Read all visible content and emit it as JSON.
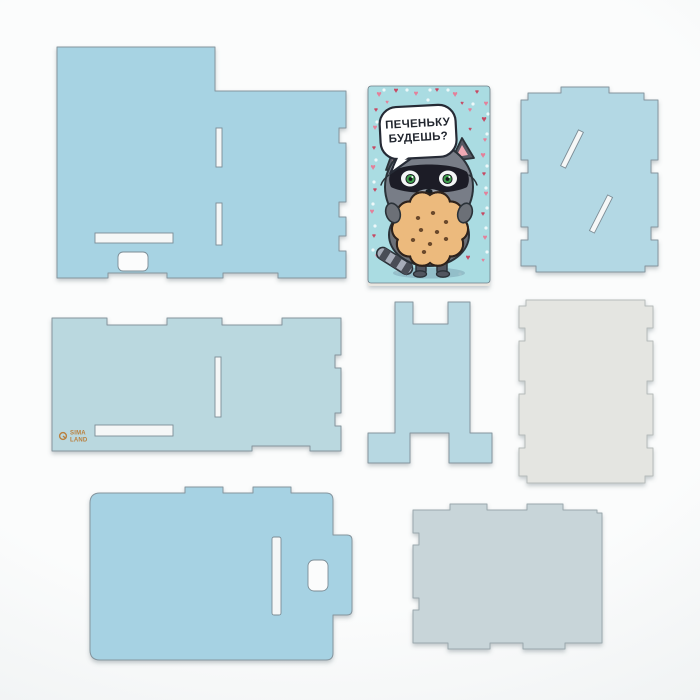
{
  "photo": {
    "description": "Flat lay of light blue laser-cut plywood kit pieces on white background",
    "background_color": "#f4f6f7"
  },
  "card": {
    "speech_line1": "ПЕЧЕНЬКУ",
    "speech_line2": "БУДЕШЬ?",
    "heart_glyph": "♥",
    "colors": {
      "card_bg": "#aadce2",
      "heart_pink": "#e4809a",
      "heart_red": "#c64a63",
      "dot_white": "#f4fbfc",
      "raccoon_gray": "#787d87",
      "raccoon_dark": "#2c3038",
      "mask_black": "#1c1f26",
      "eye_green": "#3f9e4e",
      "cookie_tan": "#ecba7d",
      "cookie_dot": "#6a482c",
      "tongue_pink": "#e2606e",
      "ear_pink": "#f0a9b4",
      "ground_shadow": "#8fb8c4"
    },
    "hearts": [
      [
        379,
        97,
        6,
        "p"
      ],
      [
        396,
        93,
        5,
        "r"
      ],
      [
        416,
        96,
        5,
        "p"
      ],
      [
        437,
        92,
        4,
        "r"
      ],
      [
        455,
        97,
        6,
        "p"
      ],
      [
        477,
        94,
        4,
        "r"
      ],
      [
        486,
        106,
        5,
        "p"
      ],
      [
        376,
        112,
        4,
        "r"
      ],
      [
        387,
        104,
        3,
        "p"
      ],
      [
        470,
        112,
        4,
        "p"
      ],
      [
        484,
        122,
        6,
        "r"
      ],
      [
        375,
        130,
        5,
        "p"
      ],
      [
        470,
        131,
        3,
        "r"
      ],
      [
        485,
        142,
        4,
        "p"
      ],
      [
        374,
        150,
        4,
        "r"
      ],
      [
        483,
        158,
        6,
        "p"
      ],
      [
        373,
        170,
        6,
        "p"
      ],
      [
        484,
        176,
        4,
        "r"
      ],
      [
        375,
        192,
        4,
        "r"
      ],
      [
        486,
        196,
        5,
        "p"
      ],
      [
        372,
        214,
        5,
        "p"
      ],
      [
        483,
        216,
        4,
        "r"
      ],
      [
        374,
        238,
        4,
        "r"
      ],
      [
        485,
        240,
        5,
        "p"
      ],
      [
        377,
        258,
        4,
        "p"
      ],
      [
        468,
        260,
        5,
        "r"
      ],
      [
        483,
        262,
        3,
        "p"
      ],
      [
        462,
        105,
        3,
        "r"
      ]
    ],
    "dots": [
      [
        384,
        90
      ],
      [
        407,
        90
      ],
      [
        428,
        100
      ],
      [
        448,
        90
      ],
      [
        473,
        104
      ],
      [
        488,
        114
      ],
      [
        377,
        122
      ],
      [
        487,
        134
      ],
      [
        376,
        160
      ],
      [
        487,
        166
      ],
      [
        374,
        182
      ],
      [
        486,
        188
      ],
      [
        373,
        204
      ],
      [
        487,
        208
      ],
      [
        375,
        226
      ],
      [
        486,
        228
      ],
      [
        373,
        250
      ],
      [
        487,
        252
      ],
      [
        397,
        272
      ],
      [
        460,
        274
      ],
      [
        430,
        90
      ]
    ]
  },
  "logo": {
    "line1": "SIMA",
    "line2": "LAND",
    "color": "#b9803f"
  },
  "pieces": [
    {
      "id": "back-panel",
      "color": "#a7d3e3"
    },
    {
      "id": "greeting-card",
      "color": "#aadce2"
    },
    {
      "id": "right-side-panel",
      "color": "#b3d8e4"
    },
    {
      "id": "shelf-panel",
      "color": "#bad8df"
    },
    {
      "id": "stand-bracket",
      "color": "#b7d8e2"
    },
    {
      "id": "white-back-panel",
      "color": "#e4e5e1"
    },
    {
      "id": "lid-panel",
      "color": "#a6d2e3"
    },
    {
      "id": "base-panel",
      "color": "#c8d5d9"
    }
  ]
}
